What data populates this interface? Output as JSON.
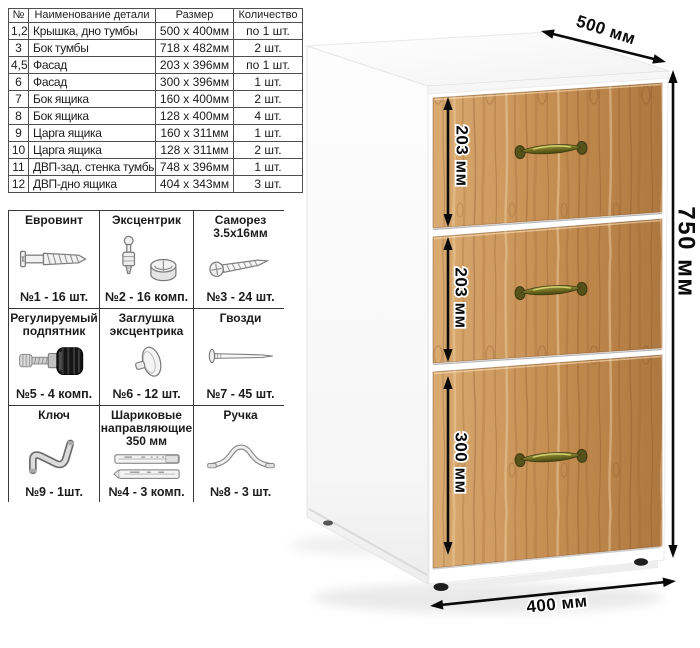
{
  "parts_table": {
    "headers": [
      "№",
      "Наименование детали",
      "Размер",
      "Количество"
    ],
    "rows": [
      [
        "1,2",
        "Крышка, дно тумбы",
        "500 x 400мм",
        "по 1 шт."
      ],
      [
        "3",
        "Бок тумбы",
        "718 x 482мм",
        "2 шт."
      ],
      [
        "4,5",
        "Фасад",
        "203 x 396мм",
        "по 1 шт."
      ],
      [
        "6",
        "Фасад",
        "300 x 396мм",
        "1 шт."
      ],
      [
        "7",
        "Бок ящика",
        "160 x 400мм",
        "2 шт."
      ],
      [
        "8",
        "Бок ящика",
        "128 x 400мм",
        "4 шт."
      ],
      [
        "9",
        "Царга ящика",
        "160 x 311мм",
        "1 шт."
      ],
      [
        "10",
        "Царга ящика",
        "128 x 311мм",
        "2 шт."
      ],
      [
        "11",
        "ДВП-зад. стенка тумбы",
        "748 x 396мм",
        "1 шт."
      ],
      [
        "12",
        "ДВП-дно ящика",
        "404 x 343мм",
        "3 шт."
      ]
    ]
  },
  "hardware": {
    "cells": [
      {
        "title": "Евровинт",
        "count": "№1 - 16 шт.",
        "icon": "euro-screw-icon"
      },
      {
        "title": "Эксцентрик",
        "count": "№2 - 16 комп.",
        "icon": "cam-lock-icon"
      },
      {
        "title": "Саморез\n3.5х16мм",
        "count": "№3 - 24 шт.",
        "icon": "tapping-screw-icon"
      },
      {
        "title": "Регулируемый\nподпятник",
        "count": "№5 - 4 комп.",
        "icon": "adjustable-foot-icon"
      },
      {
        "title": "Заглушка\nэксцентрика",
        "count": "№6 - 12 шт.",
        "icon": "cam-cap-icon"
      },
      {
        "title": "Гвозди",
        "count": "№7 - 45 шт.",
        "icon": "nail-icon"
      },
      {
        "title": "Ключ",
        "count": "№9 - 1шт.",
        "icon": "hex-key-icon"
      },
      {
        "title": "Шариковые\nнаправляющие\n350 мм",
        "count": "№4 - 3 комп.",
        "icon": "ball-slides-icon"
      },
      {
        "title": "Ручка",
        "count": "№8 - 3 шт.",
        "icon": "handle-icon"
      }
    ]
  },
  "cabinet": {
    "depth_label": "500 мм",
    "height_label": "750 мм",
    "width_label": "400 мм",
    "drawer_height_labels": [
      "203 мм",
      "203 мм",
      "300 мм"
    ],
    "colors": {
      "wood_light": "#d9ab72",
      "wood": "#c68e51",
      "wood_dark": "#ad7840",
      "handle": "#807d2a",
      "dimension_text": "#0b0b0b"
    }
  }
}
